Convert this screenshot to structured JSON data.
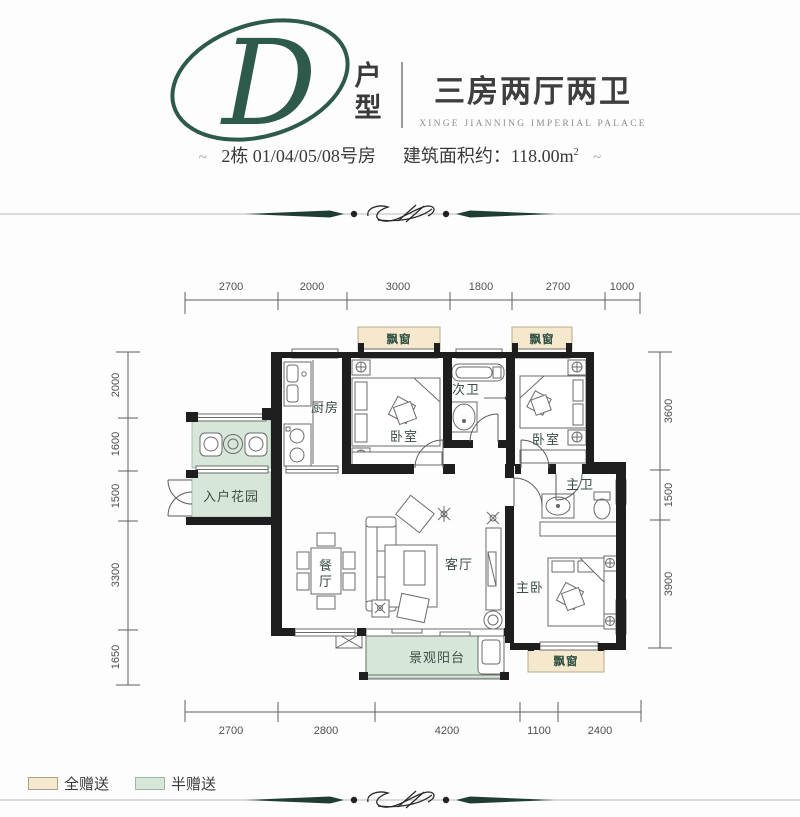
{
  "header": {
    "logo_letter": "D",
    "logo_caption": [
      "户",
      "型"
    ],
    "title": "三房两厅两卫",
    "subtitle": "XINGE JIANNING IMPERIAL PALACE",
    "flourish": "~",
    "building": "2栋 01/04/05/08号房",
    "area_prefix": "建筑面积约：",
    "area_value": "118.00m",
    "area_sup": "2"
  },
  "plan": {
    "bay_window_label": "飘窗",
    "rooms": {
      "kitchen": "厨房",
      "bedroom2": "卧室",
      "bath2": "次卫",
      "bedroom3": "卧室",
      "entry_garden": "入户花园",
      "dining": [
        "餐",
        "厅"
      ],
      "living": "客厅",
      "master_bath": "主卫",
      "master_bedroom": "主卧",
      "balcony": "景观阳台"
    },
    "dims": {
      "top": [
        "2700",
        "2000",
        "3000",
        "1800",
        "2700",
        "1000"
      ],
      "bottom": [
        "2700",
        "2800",
        "4200",
        "1100",
        "2400"
      ],
      "left": [
        "2000",
        "1600",
        "1500",
        "3300",
        "1650"
      ],
      "right": [
        "3600",
        "1500",
        "3900"
      ]
    }
  },
  "legend": {
    "full_gift": "全赠送",
    "half_gift": "半赠送"
  },
  "colors": {
    "accent_green": "#2e5a4b",
    "gift_beige": "#f5e8cd",
    "gift_green": "#d6e7da"
  }
}
